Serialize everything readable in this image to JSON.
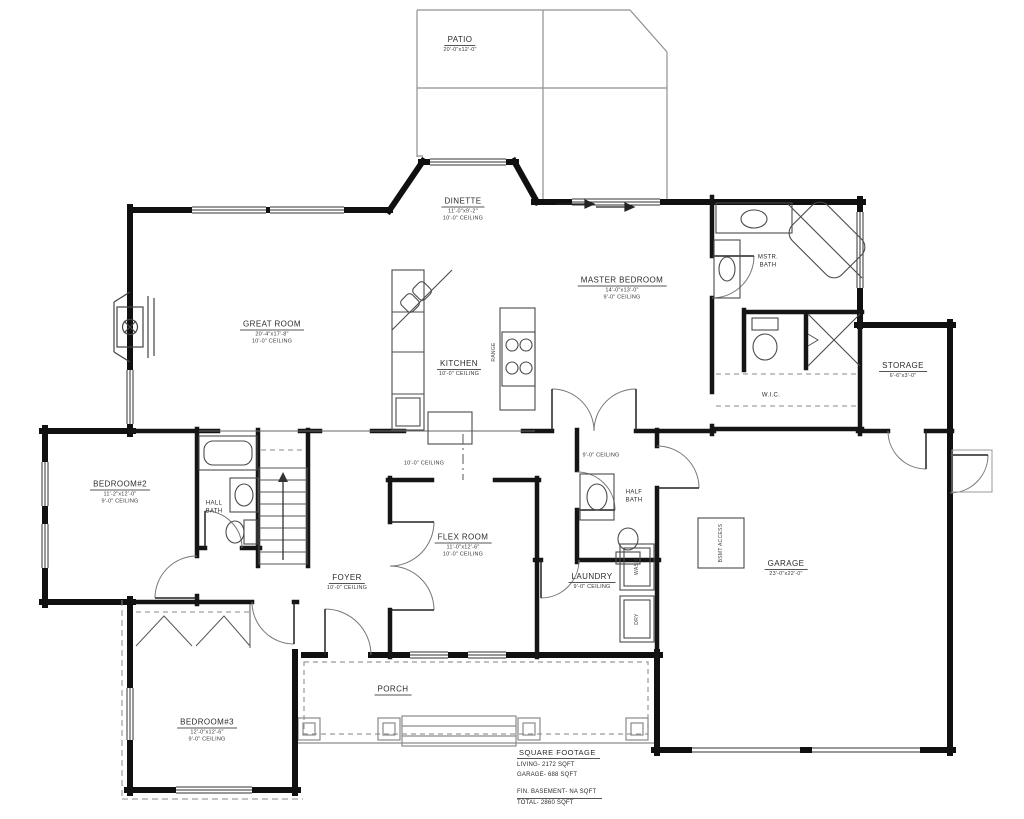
{
  "rooms": {
    "patio": {
      "name": "PATIO",
      "dims": "20'-0\"x12'-0\""
    },
    "dinette": {
      "name": "DINETTE",
      "dims": "11'-0\"x9'-2\"",
      "ceiling": "10'-0\" CEILING"
    },
    "great_room": {
      "name": "GREAT ROOM",
      "dims": "20'-4\"x17'-8\"",
      "ceiling": "10'-0\" CEILING"
    },
    "kitchen": {
      "name": "KITCHEN",
      "ceiling": "10'-0\" CEILING"
    },
    "master_bedroom": {
      "name": "MASTER BEDROOM",
      "dims": "14'-0\"x13'-0\"",
      "ceiling": "9'-0\" CEILING"
    },
    "master_bath": {
      "line1": "MSTR.",
      "line2": "BATH"
    },
    "wic": {
      "name": "W.I.C."
    },
    "storage": {
      "name": "STORAGE",
      "dims": "6'-6\"x3'-0\""
    },
    "bedroom2": {
      "name": "BEDROOM#2",
      "dims": "11'-2\"x12'-0\"",
      "ceiling": "9'-0\" CEILING"
    },
    "hall_bath": {
      "line1": "HALL",
      "line2": "BATH"
    },
    "flex_room": {
      "name": "FLEX ROOM",
      "dims": "11'-0\"x12'-6\"",
      "ceiling": "10'-0\" CEILING"
    },
    "foyer": {
      "name": "FOYER",
      "ceiling": "10'-0\" CEILING"
    },
    "laundry": {
      "name": "LAUNDRY",
      "ceiling": "9'-0\" CEILING"
    },
    "half_bath": {
      "line1": "HALF",
      "line2": "BATH"
    },
    "garage": {
      "name": "GARAGE",
      "dims": "23'-0\"x22'-0\""
    },
    "bedroom3": {
      "name": "BEDROOM#3",
      "dims": "12'-0\"x12'-6\"",
      "ceiling": "9'-0\" CEILING"
    },
    "porch": {
      "name": "PORCH"
    }
  },
  "hall_ceilings": {
    "left": "10'-0\" CEILING",
    "right": "9'-0\" CEILING"
  },
  "fixtures": {
    "range": "RANGE",
    "washer": "WASH",
    "dryer": "DRY",
    "bsmt_access": "BSMT ACCESS"
  },
  "square_footage": {
    "title": "SQUARE FOOTAGE",
    "living": "LIVING- 2172 SQFT",
    "garage": "GARAGE- 688 SQFT",
    "basement": "FIN. BASEMENT- NA SQFT",
    "total": "TOTAL- 2860 SQFT"
  },
  "colors": {
    "wall": "#101010",
    "thin": "#555555",
    "light": "#909090",
    "text": "#2b2b2b",
    "bg": "#ffffff"
  }
}
